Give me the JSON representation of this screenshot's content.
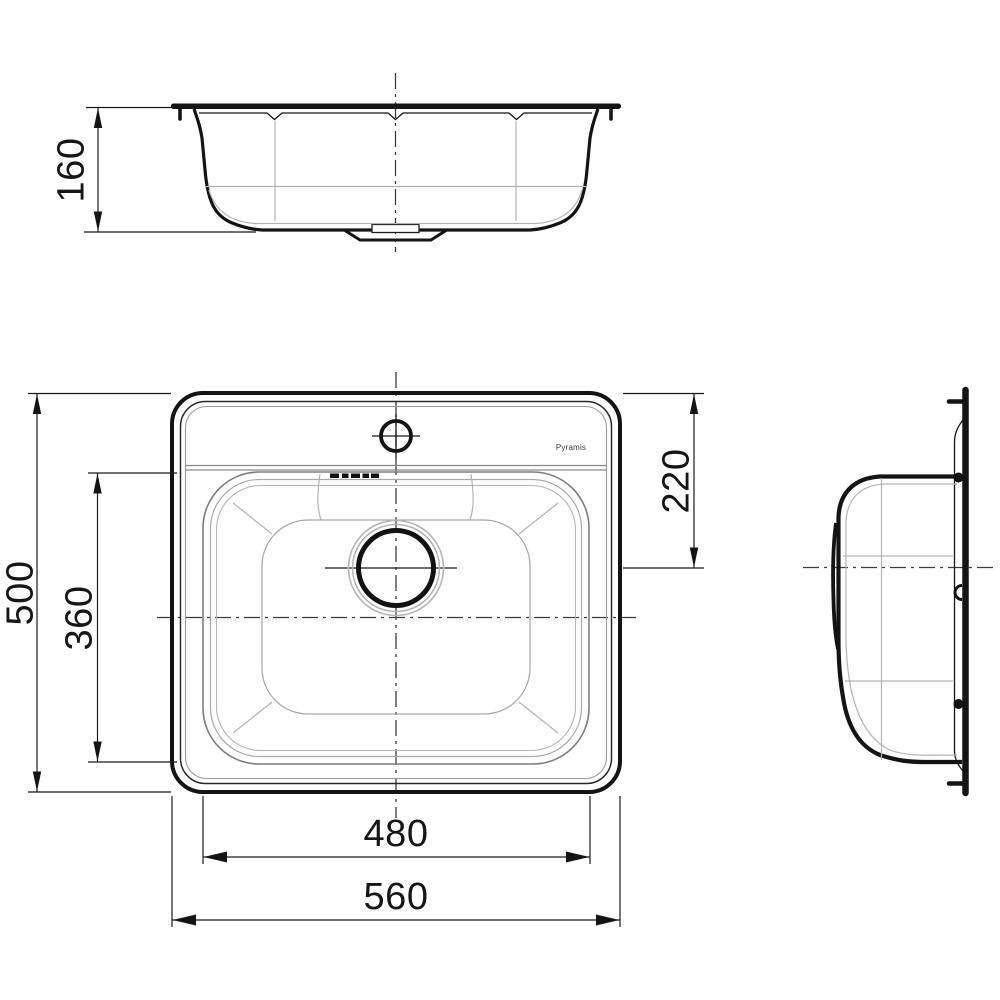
{
  "drawing": {
    "background": "#ffffff",
    "line_color": "#161616",
    "aux_line_color": "#b3b3b3",
    "centerline_color": "#3c3c3c",
    "brand_logo": "Pyramis"
  },
  "dimensions": {
    "front_height": "160",
    "plan_overall_depth": "500",
    "plan_bowl_depth": "360",
    "plan_drain_offset": "220",
    "plan_bowl_width": "480",
    "plan_overall_width": "560"
  }
}
